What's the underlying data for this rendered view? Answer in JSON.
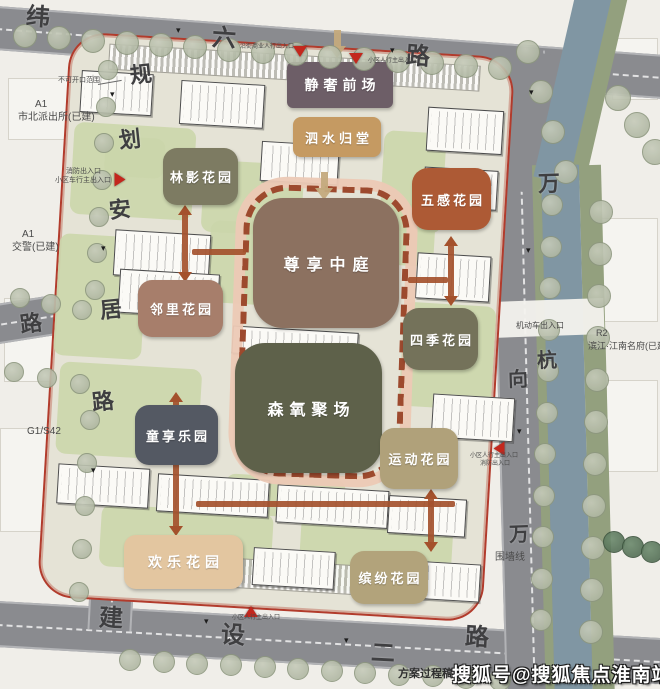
{
  "watermark": {
    "text": "搜狐号@搜狐焦点淮南站"
  },
  "note": {
    "text": "方案过程稿,"
  },
  "palette": {
    "road": "#8a8b8f",
    "canal": "#8096a3",
    "bank": "#93a07e",
    "site_base": "#e5e3d6",
    "boundary_red": "#b23b2c",
    "ring_dash": "#9d4a2e",
    "ring_band": "#ecc9b5",
    "arrow_rust": "#a4512c",
    "arrow_tan": "#c4aa7d",
    "entrance_red": "#c3271d"
  },
  "zones": [
    {
      "name": "静奢前场",
      "x": 287,
      "y": 62,
      "w": 106,
      "h": 46,
      "color": "#6d5e67",
      "fs": 14,
      "ls": 5,
      "rad": 6
    },
    {
      "name": "泗水归堂",
      "x": 293,
      "y": 117,
      "w": 88,
      "h": 40,
      "color": "#c59a62",
      "fs": 13,
      "ls": 4,
      "rad": 8
    },
    {
      "name": "林影花园",
      "x": 163,
      "y": 148,
      "w": 75,
      "h": 57,
      "color": "#7d7b62",
      "fs": 13,
      "ls": 3,
      "rad": 14
    },
    {
      "name": "五感花园",
      "x": 412,
      "y": 168,
      "w": 79,
      "h": 62,
      "color": "#ad5a35",
      "fs": 13,
      "ls": 3,
      "rad": 16
    },
    {
      "name": "尊享中庭",
      "x": 253,
      "y": 198,
      "w": 146,
      "h": 130,
      "color": "#8c7160",
      "fs": 16,
      "ls": 7,
      "rad": 30
    },
    {
      "name": "邻里花园",
      "x": 138,
      "y": 280,
      "w": 85,
      "h": 57,
      "color": "#a77e6b",
      "fs": 13,
      "ls": 3,
      "rad": 14
    },
    {
      "name": "四季花园",
      "x": 403,
      "y": 308,
      "w": 75,
      "h": 62,
      "color": "#74725a",
      "fs": 13,
      "ls": 3,
      "rad": 16
    },
    {
      "name": "森氧聚场",
      "x": 235,
      "y": 343,
      "w": 147,
      "h": 130,
      "color": "#5e614a",
      "fs": 16,
      "ls": 6,
      "rad": 30
    },
    {
      "name": "童享乐园",
      "x": 135,
      "y": 405,
      "w": 83,
      "h": 60,
      "color": "#545963",
      "fs": 13,
      "ls": 3,
      "rad": 14
    },
    {
      "name": "运动花园",
      "x": 380,
      "y": 428,
      "w": 78,
      "h": 61,
      "color": "#b0a17a",
      "fs": 13,
      "ls": 3,
      "rad": 14
    },
    {
      "name": "欢乐花园",
      "x": 124,
      "y": 535,
      "w": 119,
      "h": 54,
      "color": "#e3c6a0",
      "fs": 14,
      "ls": 5,
      "rad": 12
    },
    {
      "name": "缤纷花园",
      "x": 350,
      "y": 551,
      "w": 78,
      "h": 53,
      "color": "#b2a37b",
      "fs": 13,
      "ls": 3,
      "rad": 14
    }
  ],
  "road_labels": [
    {
      "t": "纬",
      "x": 26,
      "y": 6,
      "s": 24,
      "r": 4
    },
    {
      "t": "六",
      "x": 212,
      "y": 27,
      "s": 24,
      "r": 4
    },
    {
      "t": "路",
      "x": 406,
      "y": 45,
      "s": 24,
      "r": 4
    },
    {
      "t": "规",
      "x": 130,
      "y": 64,
      "s": 22,
      "r": -6
    },
    {
      "t": "划",
      "x": 119,
      "y": 129,
      "s": 22,
      "r": -6
    },
    {
      "t": "安",
      "x": 109,
      "y": 199,
      "s": 22,
      "r": -6
    },
    {
      "t": "居",
      "x": 100,
      "y": 299,
      "s": 22,
      "r": -6
    },
    {
      "t": "路",
      "x": 92,
      "y": 391,
      "s": 22,
      "r": -6
    },
    {
      "t": "路",
      "x": 20,
      "y": 313,
      "s": 22,
      "r": -8
    },
    {
      "t": "建",
      "x": 99,
      "y": 607,
      "s": 24,
      "r": 3
    },
    {
      "t": "设",
      "x": 221,
      "y": 624,
      "s": 24,
      "r": 3
    },
    {
      "t": "二",
      "x": 371,
      "y": 642,
      "s": 24,
      "r": 3
    },
    {
      "t": "路",
      "x": 465,
      "y": 626,
      "s": 24,
      "r": 3
    },
    {
      "t": "万",
      "x": 538,
      "y": 173,
      "s": 22,
      "r": -2
    },
    {
      "t": "向",
      "x": 508,
      "y": 370,
      "s": 20,
      "r": -2
    },
    {
      "t": "杭",
      "x": 537,
      "y": 351,
      "s": 20,
      "r": -2
    },
    {
      "t": "万",
      "x": 509,
      "y": 525,
      "s": 20,
      "r": -2
    }
  ],
  "annotations": [
    {
      "t": "不可开口范围",
      "x": 58,
      "y": 77,
      "s": 7
    },
    {
      "t": "消防出入口",
      "x": 66,
      "y": 168,
      "s": 7
    },
    {
      "t": "小区车行主出入口",
      "x": 55,
      "y": 177,
      "s": 7
    },
    {
      "t": "沿街商业人行出入口",
      "x": 240,
      "y": 44,
      "s": 6
    },
    {
      "t": "小区人行主出入口",
      "x": 368,
      "y": 58,
      "s": 6
    },
    {
      "t": "机动车出入口",
      "x": 516,
      "y": 321,
      "s": 8
    },
    {
      "t": "小区人行主出入口",
      "x": 470,
      "y": 453,
      "s": 6
    },
    {
      "t": "消防出入口",
      "x": 480,
      "y": 461,
      "s": 6
    },
    {
      "t": "围墙线",
      "x": 495,
      "y": 552,
      "s": 10
    },
    {
      "t": "小区人行主出入口",
      "x": 232,
      "y": 615,
      "s": 6
    },
    {
      "t": "A1",
      "x": 35,
      "y": 99,
      "s": 10
    },
    {
      "t": "市北派出所(已建)",
      "x": 18,
      "y": 112,
      "s": 10
    },
    {
      "t": "A1",
      "x": 22,
      "y": 229,
      "s": 10
    },
    {
      "t": "交警(已建)",
      "x": 12,
      "y": 242,
      "s": 10
    },
    {
      "t": "G1/S42",
      "x": 27,
      "y": 426,
      "s": 10
    },
    {
      "t": "R2",
      "x": 596,
      "y": 328,
      "s": 9
    },
    {
      "t": "滨江·江南名府(已建",
      "x": 588,
      "y": 341,
      "s": 9
    }
  ],
  "traffic_marks": [
    [
      176,
      26
    ],
    [
      390,
      46
    ],
    [
      110,
      90
    ],
    [
      101,
      244
    ],
    [
      91,
      466
    ],
    [
      204,
      617
    ],
    [
      344,
      636
    ],
    [
      526,
      246
    ],
    [
      517,
      427
    ],
    [
      529,
      88
    ]
  ],
  "entrances": [
    {
      "x": 113,
      "y": 174,
      "rot": -90
    },
    {
      "x": 293,
      "y": 46,
      "rot": 0
    },
    {
      "x": 349,
      "y": 53,
      "rot": 0
    },
    {
      "x": 492,
      "y": 443,
      "rot": 90
    },
    {
      "x": 244,
      "y": 606,
      "rot": 180
    }
  ],
  "arrows": {
    "vertical": [
      [
        185,
        205,
        282
      ],
      [
        451,
        236,
        306
      ],
      [
        176,
        392,
        536
      ],
      [
        431,
        489,
        552
      ]
    ],
    "horizontal": [
      [
        196,
        455,
        501
      ],
      [
        192,
        246,
        249
      ],
      [
        408,
        448,
        277
      ]
    ],
    "tan": [
      [
        337,
        30
      ],
      [
        324,
        172
      ]
    ]
  },
  "tree_rows": [
    {
      "x1": 25,
      "y1": 36,
      "x2": 500,
      "y2": 68,
      "n": 15,
      "r": 12
    },
    {
      "x1": 528,
      "y1": 52,
      "x2": 566,
      "y2": 172,
      "n": 4,
      "r": 12
    },
    {
      "x1": 618,
      "y1": 98,
      "x2": 655,
      "y2": 152,
      "n": 3,
      "r": 13
    },
    {
      "x1": 552,
      "y1": 205,
      "x2": 541,
      "y2": 620,
      "n": 11,
      "r": 11
    },
    {
      "x1": 601,
      "y1": 212,
      "x2": 591,
      "y2": 632,
      "n": 11,
      "r": 12
    },
    {
      "x1": 108,
      "y1": 70,
      "x2": 95,
      "y2": 290,
      "n": 7,
      "r": 10
    },
    {
      "x1": 20,
      "y1": 298,
      "x2": 82,
      "y2": 310,
      "n": 3,
      "r": 10
    },
    {
      "x1": 14,
      "y1": 372,
      "x2": 80,
      "y2": 384,
      "n": 3,
      "r": 10
    },
    {
      "x1": 90,
      "y1": 420,
      "x2": 79,
      "y2": 592,
      "n": 5,
      "r": 10
    },
    {
      "x1": 130,
      "y1": 660,
      "x2": 500,
      "y2": 680,
      "n": 12,
      "r": 11
    },
    {
      "x1": 614,
      "y1": 542,
      "x2": 652,
      "y2": 552,
      "n": 3,
      "r": 11,
      "dark": true
    }
  ],
  "buildings": [
    [
      12,
      36,
      72,
      42
    ],
    [
      112,
      40,
      84,
      44
    ],
    [
      360,
      52,
      76,
      44
    ],
    [
      196,
      96,
      78,
      40
    ],
    [
      360,
      112,
      74,
      40
    ],
    [
      55,
      193,
      96,
      46
    ],
    [
      358,
      198,
      74,
      46
    ],
    [
      62,
      232,
      100,
      44
    ],
    [
      178,
      282,
      126,
      28
    ],
    [
      382,
      338,
      82,
      44
    ],
    [
      12,
      430,
      92,
      40
    ],
    [
      112,
      434,
      112,
      38
    ],
    [
      232,
      438,
      112,
      38
    ],
    [
      344,
      442,
      78,
      38
    ],
    [
      212,
      502,
      82,
      38
    ],
    [
      360,
      506,
      80,
      38
    ]
  ],
  "green_patches": [
    [
      8,
      88,
      122,
      92
    ],
    [
      140,
      118,
      100,
      72
    ],
    [
      0,
      200,
      88,
      122
    ],
    [
      318,
      78,
      62,
      100
    ],
    [
      348,
      248,
      92,
      104
    ],
    [
      8,
      328,
      142,
      92
    ],
    [
      58,
      468,
      172,
      62
    ],
    [
      258,
      468,
      152,
      72
    ],
    [
      150,
      178,
      62,
      82
    ],
    [
      330,
      150,
      44,
      62
    ],
    [
      180,
      430,
      120,
      40
    ],
    [
      40,
      100,
      60,
      40
    ]
  ],
  "stripe_bands": [
    [
      38,
      8,
      372,
      26
    ],
    [
      150,
      514,
      262,
      30
    ]
  ],
  "outer_buildings": [
    [
      8,
      78,
      84,
      62
    ],
    [
      4,
      298,
      92,
      84
    ],
    [
      600,
      218,
      58,
      104
    ],
    [
      606,
      380,
      52,
      92
    ],
    [
      0,
      428,
      80,
      104
    ],
    [
      612,
      38,
      46,
      62
    ]
  ],
  "roads_geometry": {
    "top": {
      "x": -30,
      "y": 4,
      "w": 740,
      "h": 44,
      "rot": 4.2
    },
    "left": {
      "x": 118,
      "y": 46,
      "w": 44,
      "h": 584,
      "rot": 3
    },
    "right": {
      "x": 489,
      "y": 52,
      "w": 56,
      "h": 640,
      "rot": -1.5
    },
    "bottom": {
      "x": -20,
      "y": 600,
      "w": 720,
      "h": 46,
      "rot": 3.2
    },
    "stub": {
      "x": -10,
      "y": 305,
      "w": 132,
      "h": 40,
      "rot": -9
    },
    "corner": {
      "x": 478,
      "y": 52,
      "w": 100,
      "h": 140,
      "rot": 8
    }
  },
  "canal_geometry": {
    "vertical": {
      "x": 548,
      "y": 165,
      "w": 38,
      "h": 540,
      "rot": -1.5
    },
    "diagonal": {
      "x": 556,
      "y": -22,
      "w": 36,
      "h": 205,
      "rot": 13
    },
    "bank_left": {
      "x": 539,
      "y": 165,
      "w": 9,
      "h": 540,
      "rot": -1.5
    },
    "bank_right": {
      "x": 586,
      "y": 165,
      "w": 22,
      "h": 540,
      "rot": -1.5
    },
    "bank_diag": {
      "x": 586,
      "y": -18,
      "w": 22,
      "h": 200,
      "rot": 13
    },
    "crossing": {
      "x": 492,
      "y": 300,
      "w": 112,
      "h": 36,
      "rot": -2
    }
  },
  "ring_geometry": {
    "x": 240,
    "y": 186,
    "w": 166,
    "h": 292,
    "rot": 2
  }
}
